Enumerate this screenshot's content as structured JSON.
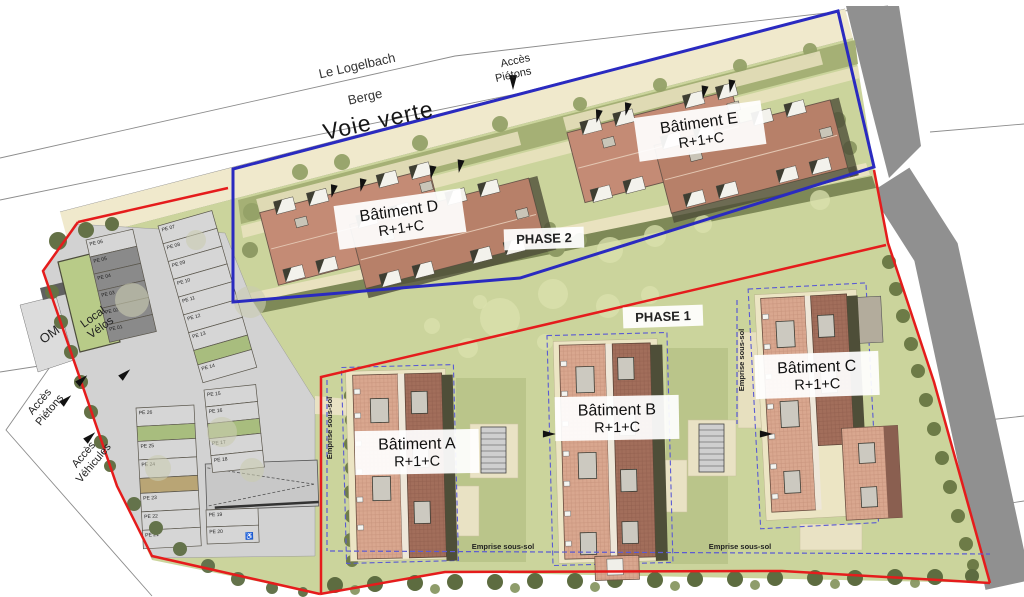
{
  "labels": {
    "roads": {
      "le_logelbach": "Le Logelbach",
      "berge": "Berge",
      "voie_verte": "Voie verte"
    },
    "access_top": {
      "l1": "Accès",
      "l2": "Piétons"
    },
    "access_left": {
      "l1": "Accès",
      "l2": "Piétons"
    },
    "access_vehicles": {
      "l1": "Accès",
      "l2": "Véhicules"
    },
    "phases": {
      "phase1": "PHASE 1",
      "phase2": "PHASE 2"
    },
    "buildings": {
      "a": {
        "name": "Bâtiment A",
        "floors": "R+1+C"
      },
      "b": {
        "name": "Bâtiment B",
        "floors": "R+1+C"
      },
      "c": {
        "name": "Bâtiment C",
        "floors": "R+1+C"
      },
      "d": {
        "name": "Bâtiment D",
        "floors": "R+1+C"
      },
      "e": {
        "name": "Bâtiment E",
        "floors": "R+1+C"
      }
    },
    "facilities": {
      "om": "OM",
      "velos1": "Local",
      "velos2": "Vélos"
    },
    "emprise": {
      "label": "Emprise sous-sol"
    }
  },
  "colors": {
    "boundary_red": "#e51c1c",
    "boundary_blue": "#2a2ac0",
    "phase1_text": "#d42525",
    "phase2_text": "#4343cb",
    "emprise_text": "#3946c0",
    "emprise_line": "#5a5ad4",
    "lawn": "#cbd49c",
    "band_cream": "#f0e9cc",
    "garden_olive": "#a5b075",
    "walk_cream": "#e9e2bf",
    "dark_band": "#7e8957",
    "parking_asphalt": "#d2d2d2",
    "stall_light": "#d6d6d6",
    "stall_dark": "#8a8a8a",
    "planter_green": "#a8bd7e",
    "planter_tan": "#b9a575",
    "roof_salmon_1": "#c48b75",
    "roof_salmon_2": "#b78069",
    "brick_light": "#d9a78f",
    "brick_dark": "#a26e5b",
    "shadow_olive": "#4e4e38",
    "gray_road": "#909090"
  },
  "parking": {
    "columns": [
      {
        "x": 86,
        "y": 240,
        "w": 48,
        "pitch": 17.5,
        "rot": -13,
        "stalls": [
          {
            "l": "PE 06"
          },
          {
            "l": "PE 05",
            "dark": true
          },
          {
            "l": "PE 04",
            "dark": true
          },
          {
            "l": "PE 03",
            "dark": true
          },
          {
            "l": "PE 02",
            "dark": true
          },
          {
            "l": "PE 01",
            "dark": true
          }
        ]
      },
      {
        "x": 158,
        "y": 226,
        "w": 56,
        "pitch": 18.5,
        "rot": -16,
        "stalls": [
          {
            "l": "PE 07"
          },
          {
            "l": "PE 08"
          },
          {
            "l": "PE 09"
          },
          {
            "l": "PE 10"
          },
          {
            "l": "PE 11"
          },
          {
            "l": "PE 12"
          },
          {
            "l": "PE 13"
          },
          {
            "p": 1
          },
          {
            "l": "PE 14"
          }
        ]
      },
      {
        "x": 204,
        "y": 390,
        "w": 52,
        "pitch": 17,
        "rot": -6,
        "stalls": [
          {
            "l": "PE 15"
          },
          {
            "l": "PE 16"
          },
          {
            "p": 1
          },
          {
            "l": "PE 17"
          },
          {
            "l": "PE 18"
          }
        ]
      },
      {
        "x": 206,
        "y": 510,
        "w": 52,
        "pitch": 17,
        "rot": -2,
        "stalls": [
          {
            "l": "PE 19"
          },
          {
            "l": "PE 20",
            "hc": true
          }
        ]
      },
      {
        "x": 136,
        "y": 408,
        "w": 58,
        "pitch": 18.5,
        "rot": -3,
        "stalls": [
          {
            "l": "PE 26"
          },
          {
            "p": 1
          },
          {
            "l": "PE 25"
          },
          {
            "l": "PE 24"
          },
          {
            "p": 2
          },
          {
            "l": "PE 23"
          },
          {
            "l": "PE 22"
          },
          {
            "l": "PE 21"
          }
        ]
      }
    ]
  },
  "landscape": {
    "groups": [
      {
        "name": "lawn-trees-pale",
        "fill": "#dbe2ae",
        "opacity": 0.75,
        "items": [
          [
            500,
            318,
            20
          ],
          [
            553,
            294,
            15
          ],
          [
            608,
            306,
            12
          ],
          [
            468,
            348,
            10
          ],
          [
            432,
            326,
            8
          ],
          [
            650,
            295,
            9
          ],
          [
            545,
            342,
            8
          ],
          [
            610,
            250,
            13
          ],
          [
            655,
            236,
            11
          ],
          [
            703,
            224,
            9
          ],
          [
            820,
            200,
            10
          ],
          [
            480,
            302,
            7
          ]
        ]
      },
      {
        "name": "parking-trees-pale",
        "fill": "#c9ccb1",
        "opacity": 0.6,
        "items": [
          [
            250,
            302,
            16
          ],
          [
            222,
            432,
            15
          ],
          [
            158,
            468,
            13
          ],
          [
            132,
            300,
            17
          ],
          [
            252,
            470,
            12
          ],
          [
            196,
            240,
            10
          ]
        ]
      },
      {
        "name": "voie-verte-garden-trees",
        "fill": "#93a167",
        "opacity": 0.95,
        "items": [
          [
            300,
            172,
            8
          ],
          [
            342,
            162,
            8
          ],
          [
            420,
            143,
            8
          ],
          [
            500,
            124,
            8
          ],
          [
            580,
            104,
            7
          ],
          [
            660,
            85,
            7
          ],
          [
            740,
            66,
            7
          ],
          [
            810,
            50,
            7
          ],
          [
            252,
            212,
            9
          ]
        ]
      },
      {
        "name": "hedge-left-of-building-a",
        "fill": "#6f7d49",
        "opacity": 1,
        "items": [
          [
            351,
            396,
            7
          ],
          [
            352,
            420,
            7
          ],
          [
            351,
            444,
            7
          ],
          [
            352,
            468,
            7
          ],
          [
            351,
            492,
            7
          ],
          [
            352,
            516,
            7
          ],
          [
            351,
            540,
            7
          ],
          [
            352,
            561,
            6
          ]
        ]
      },
      {
        "name": "hedge-right-boundary",
        "fill": "#6d7b47",
        "opacity": 1,
        "items": [
          [
            889,
            262,
            7
          ],
          [
            896,
            289,
            7
          ],
          [
            903,
            316,
            7
          ],
          [
            911,
            344,
            7
          ],
          [
            918,
            371,
            7
          ],
          [
            926,
            400,
            7
          ],
          [
            934,
            429,
            7
          ],
          [
            942,
            458,
            7
          ],
          [
            950,
            487,
            7
          ],
          [
            958,
            516,
            7
          ],
          [
            966,
            544,
            7
          ],
          [
            973,
            565,
            6
          ]
        ]
      },
      {
        "name": "hedge-bottom-row",
        "fill": "#5d6c40",
        "opacity": 1,
        "items": [
          [
            335,
            585,
            8
          ],
          [
            375,
            584,
            8
          ],
          [
            415,
            583,
            8
          ],
          [
            455,
            582,
            8
          ],
          [
            495,
            582,
            8
          ],
          [
            535,
            581,
            8
          ],
          [
            575,
            581,
            8
          ],
          [
            615,
            580,
            8
          ],
          [
            655,
            580,
            8
          ],
          [
            695,
            579,
            8
          ],
          [
            735,
            579,
            8
          ],
          [
            775,
            578,
            8
          ],
          [
            815,
            578,
            8
          ],
          [
            855,
            578,
            8
          ],
          [
            895,
            577,
            8
          ],
          [
            935,
            577,
            8
          ],
          [
            972,
            576,
            7
          ]
        ]
      },
      {
        "name": "hedge-bottom-row-2",
        "fill": "#82915a",
        "opacity": 0.9,
        "items": [
          [
            355,
            590,
            5
          ],
          [
            435,
            589,
            5
          ],
          [
            515,
            588,
            5
          ],
          [
            595,
            587,
            5
          ],
          [
            675,
            586,
            5
          ],
          [
            755,
            585,
            5
          ],
          [
            835,
            584,
            5
          ],
          [
            915,
            583,
            5
          ]
        ]
      },
      {
        "name": "hedge-west-boundary",
        "fill": "#647146",
        "opacity": 1,
        "items": [
          [
            52,
            292,
            7
          ],
          [
            61,
            322,
            7
          ],
          [
            71,
            352,
            7
          ],
          [
            81,
            382,
            7
          ],
          [
            91,
            412,
            7
          ],
          [
            101,
            442,
            7
          ],
          [
            110,
            466,
            6
          ],
          [
            58,
            241,
            9
          ],
          [
            86,
            230,
            8
          ],
          [
            112,
            224,
            7
          ]
        ]
      },
      {
        "name": "hedge-southwest-boundary",
        "fill": "#64734b",
        "opacity": 1,
        "items": [
          [
            134,
            504,
            7
          ],
          [
            156,
            528,
            7
          ],
          [
            180,
            549,
            7
          ],
          [
            208,
            566,
            7
          ],
          [
            238,
            579,
            7
          ],
          [
            272,
            588,
            6
          ],
          [
            303,
            592,
            5
          ]
        ]
      },
      {
        "name": "phase2-garden-trees",
        "fill": "#8e9a64",
        "opacity": 1,
        "items": [
          [
            556,
            248,
            9
          ],
          [
            580,
            240,
            7
          ],
          [
            550,
            228,
            6
          ],
          [
            838,
            120,
            8
          ],
          [
            850,
            148,
            7
          ],
          [
            250,
            250,
            8
          ]
        ]
      }
    ]
  },
  "phase2_buildings": [
    {
      "container": "dormers-d",
      "dormers": [
        [
          284,
          171
        ],
        [
          318,
          171
        ],
        [
          390,
          171
        ],
        [
          424,
          171
        ],
        [
          360,
          205
        ],
        [
          394,
          205
        ],
        [
          452,
          205
        ],
        [
          486,
          205
        ],
        [
          368,
          268
        ],
        [
          402,
          268
        ],
        [
          462,
          268
        ],
        [
          496,
          268
        ],
        [
          276,
          239
        ],
        [
          310,
          239
        ]
      ],
      "skylights": [
        [
          300,
          193
        ],
        [
          430,
          190
        ],
        [
          380,
          228
        ],
        [
          516,
          240
        ]
      ]
    },
    {
      "container": "dormers-e",
      "dormers": [
        [
          590,
          93
        ],
        [
          624,
          93
        ],
        [
          696,
          93
        ],
        [
          730,
          93
        ],
        [
          664,
          127
        ],
        [
          698,
          127
        ],
        [
          758,
          127
        ],
        [
          792,
          127
        ],
        [
          672,
          189
        ],
        [
          706,
          189
        ],
        [
          768,
          189
        ],
        [
          802,
          189
        ],
        [
          583,
          161
        ],
        [
          617,
          161
        ]
      ],
      "skylights": [
        [
          607,
          115
        ],
        [
          737,
          112
        ],
        [
          688,
          150
        ],
        [
          820,
          160
        ]
      ]
    }
  ],
  "arrows": [
    [
      513,
      82,
      90,
      8
    ],
    [
      82,
      380,
      -42,
      7
    ],
    [
      125,
      374,
      -42,
      7
    ],
    [
      66,
      400,
      -42,
      7
    ],
    [
      90,
      437,
      -42,
      7
    ],
    [
      333,
      191,
      102,
      7
    ],
    [
      362,
      185,
      102,
      7
    ],
    [
      432,
      172,
      100,
      7
    ],
    [
      460,
      166,
      100,
      7
    ],
    [
      598,
      116,
      102,
      7
    ],
    [
      627,
      109,
      102,
      7
    ],
    [
      704,
      92,
      100,
      7
    ],
    [
      731,
      86,
      100,
      7
    ],
    [
      549,
      434,
      0,
      7
    ],
    [
      766,
      434,
      0,
      7
    ]
  ]
}
